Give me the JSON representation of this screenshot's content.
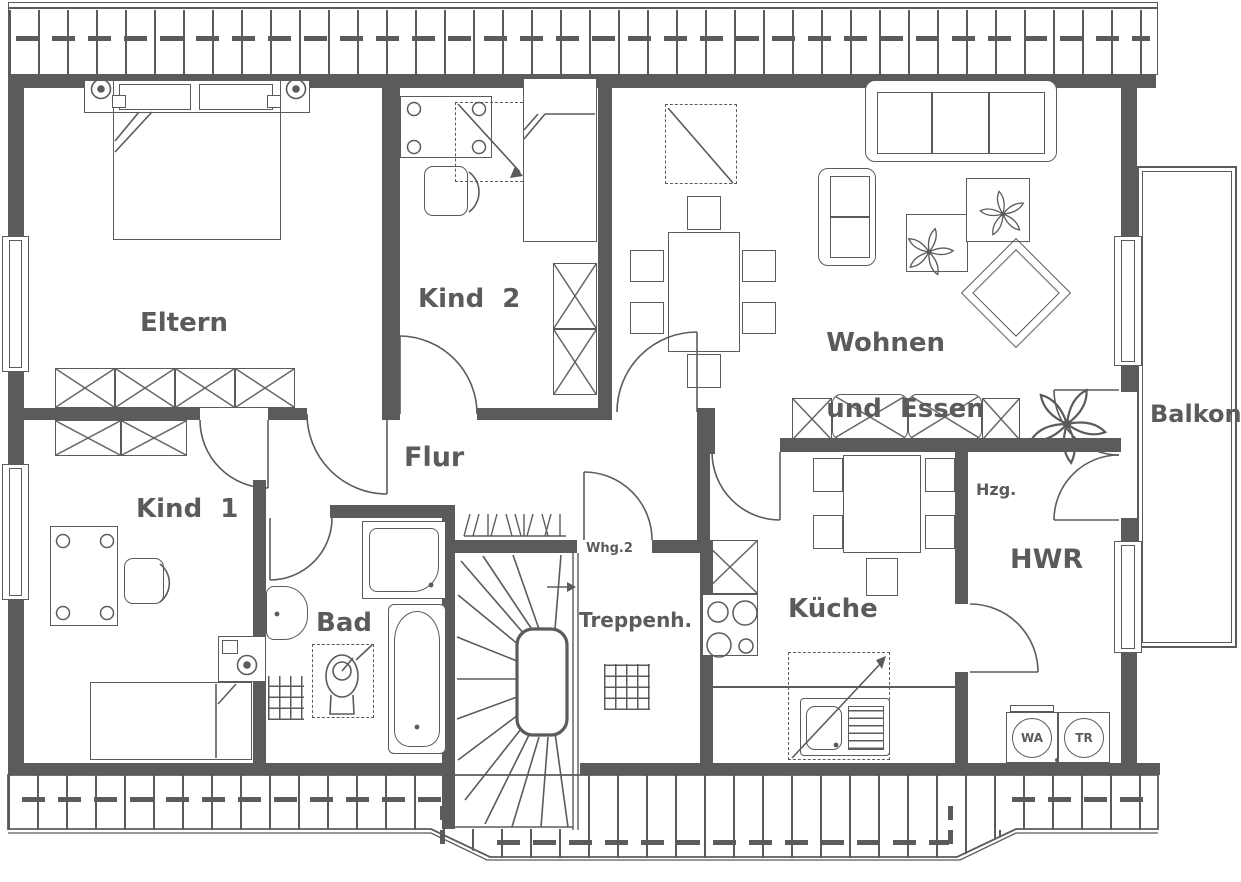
{
  "plan": {
    "rooms": {
      "eltern": "Eltern",
      "kind2": "Kind  2",
      "kind1": "Kind  1",
      "flur": "Flur",
      "bad": "Bad",
      "treppenhaus": "Treppenh.",
      "kueche": "Küche",
      "hwr": "HWR",
      "wohnen_line1": "Wohnen",
      "wohnen_line2": "und  Essen",
      "balkon": "Balkon"
    },
    "annotations": {
      "apartment": "Whg.2",
      "heating": "Hzg.",
      "washing_machine": "WA",
      "dryer": "TR"
    },
    "colors": {
      "line": "#5b5b5b",
      "background": "#ffffff"
    }
  }
}
